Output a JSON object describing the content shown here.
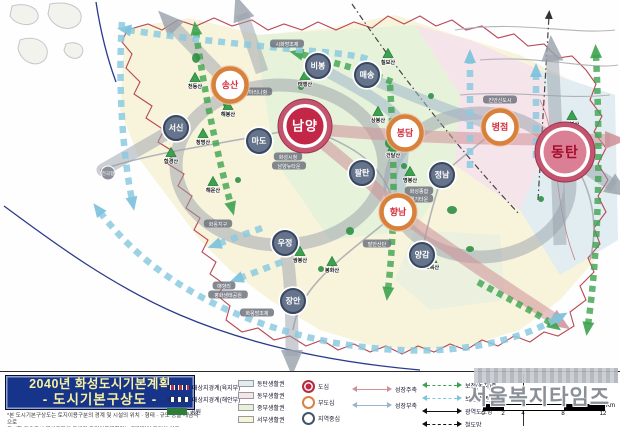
{
  "title": {
    "line1": "2040년 화성도시기본계획",
    "line2": "- 도시기본구상도 -",
    "disclaimer1": "*본 도시기본구상도는 토지이용구분의 경계 및 시설의 위치 · 형태 · 규모 등을 개념적으로",
    "disclaimer2": "도시한 것으로서 개별토지의 구체적 토지이용계획과는 직접적인 관련이 없음"
  },
  "legend": {
    "boundaries": [
      {
        "label": "대상지경계(육지부)",
        "color": "#b23545",
        "color2": "#1e2d6e"
      },
      {
        "label": "대상지경계(해안부)",
        "color": "#1e2d6e"
      },
      {
        "label": "공원",
        "color": "#2f7d3a"
      }
    ],
    "zones": [
      {
        "label": "동탄생활권",
        "color": "#dfecf1"
      },
      {
        "label": "동부생활권",
        "color": "#f6e3eb"
      },
      {
        "label": "중부생활권",
        "color": "#e6f1da"
      },
      {
        "label": "서부생활권",
        "color": "#f8f4d8"
      }
    ],
    "centers": [
      {
        "label": "도심",
        "ring": "#b0303f",
        "fill": "#c22748"
      },
      {
        "label": "부도심",
        "ring": "#d9833f",
        "fill": ""
      },
      {
        "label": "지역중심",
        "ring": "#44536b",
        "fill": ""
      }
    ],
    "axes": [
      {
        "label": "성장주축",
        "color": "#cf9097",
        "dashed": false
      },
      {
        "label": "성장부축",
        "color": "#9ab4c9",
        "dashed": false
      },
      {
        "label": "보전(녹지)축",
        "color": "#3da24f",
        "dashed": true
      },
      {
        "label": "보전(수변)축",
        "color": "#7fc3dc",
        "dashed": true
      },
      {
        "label": "광역도로망",
        "color": "#111111",
        "dashed": false
      },
      {
        "label": "철도망",
        "color": "#111111",
        "dashed": true
      }
    ],
    "scale": {
      "ticks": [
        "0",
        "2",
        "4",
        "8",
        "12"
      ],
      "unit": "Km"
    }
  },
  "watermark": "서울복지타임즈",
  "map": {
    "nodes": [
      {
        "label": "남양",
        "type": "main",
        "x": 305,
        "y": 126,
        "r": 27,
        "inner": "#c22748",
        "text": "#ffffff",
        "fs": 13
      },
      {
        "label": "동탄",
        "type": "main",
        "x": 565,
        "y": 152,
        "r": 30,
        "inner": "#db8094",
        "text": "#a50d2d",
        "fs": 14
      },
      {
        "label": "송산",
        "type": "sub",
        "x": 230,
        "y": 85
      },
      {
        "label": "봉담",
        "type": "sub",
        "x": 405,
        "y": 133
      },
      {
        "label": "병점",
        "type": "sub",
        "x": 500,
        "y": 127
      },
      {
        "label": "향남",
        "type": "sub",
        "x": 398,
        "y": 212
      },
      {
        "label": "서신",
        "type": "local",
        "x": 176,
        "y": 128
      },
      {
        "label": "마도",
        "type": "local",
        "x": 259,
        "y": 141
      },
      {
        "label": "비봉",
        "type": "local",
        "x": 318,
        "y": 66
      },
      {
        "label": "매송",
        "type": "local",
        "x": 367,
        "y": 75
      },
      {
        "label": "팔탄",
        "type": "local",
        "x": 362,
        "y": 173
      },
      {
        "label": "정남",
        "type": "local",
        "x": 442,
        "y": 175
      },
      {
        "label": "우정",
        "type": "local",
        "x": 285,
        "y": 243
      },
      {
        "label": "장안",
        "type": "local",
        "x": 293,
        "y": 301
      },
      {
        "label": "양감",
        "type": "local",
        "x": 422,
        "y": 255
      }
    ],
    "mountains": [
      {
        "label": "천등산",
        "x": 195,
        "y": 78
      },
      {
        "label": "해봉산",
        "x": 228,
        "y": 106
      },
      {
        "label": "태행산",
        "x": 305,
        "y": 76
      },
      {
        "label": "칠보산",
        "x": 388,
        "y": 54
      },
      {
        "label": "상봉산",
        "x": 378,
        "y": 112
      },
      {
        "label": "청명산",
        "x": 203,
        "y": 134
      },
      {
        "label": "함경산",
        "x": 171,
        "y": 153
      },
      {
        "label": "해운산",
        "x": 213,
        "y": 182
      },
      {
        "label": "건달산",
        "x": 393,
        "y": 147
      },
      {
        "label": "명봉산",
        "x": 410,
        "y": 172
      },
      {
        "label": "쌍봉산",
        "x": 300,
        "y": 252
      },
      {
        "label": "봉화산",
        "x": 332,
        "y": 262
      },
      {
        "label": "초록산",
        "x": 432,
        "y": 259
      },
      {
        "label": "무봉산",
        "x": 572,
        "y": 116
      }
    ],
    "places": [
      {
        "label": "시화방조제",
        "x": 287,
        "y": 44
      },
      {
        "label": "마리나항",
        "x": 258,
        "y": 92
      },
      {
        "label": "화성시청",
        "x": 288,
        "y": 157
      },
      {
        "label": "남양뉴타운",
        "x": 289,
        "y": 166
      },
      {
        "label": "진안신도시",
        "x": 500,
        "y": 100
      },
      {
        "label": "화성종합",
        "x": 419,
        "y": 191
      },
      {
        "label": "경기타운",
        "x": 419,
        "y": 199
      },
      {
        "label": "발안산단",
        "x": 377,
        "y": 244
      },
      {
        "label": "화옹지구",
        "x": 218,
        "y": 224
      },
      {
        "label": "매향리",
        "x": 224,
        "y": 286
      },
      {
        "label": "평화생태공원",
        "x": 228,
        "y": 295
      },
      {
        "label": "화옹방조제",
        "x": 257,
        "y": 313
      },
      {
        "label": "전곡항",
        "x": 108,
        "y": 173,
        "circle": true
      }
    ]
  }
}
